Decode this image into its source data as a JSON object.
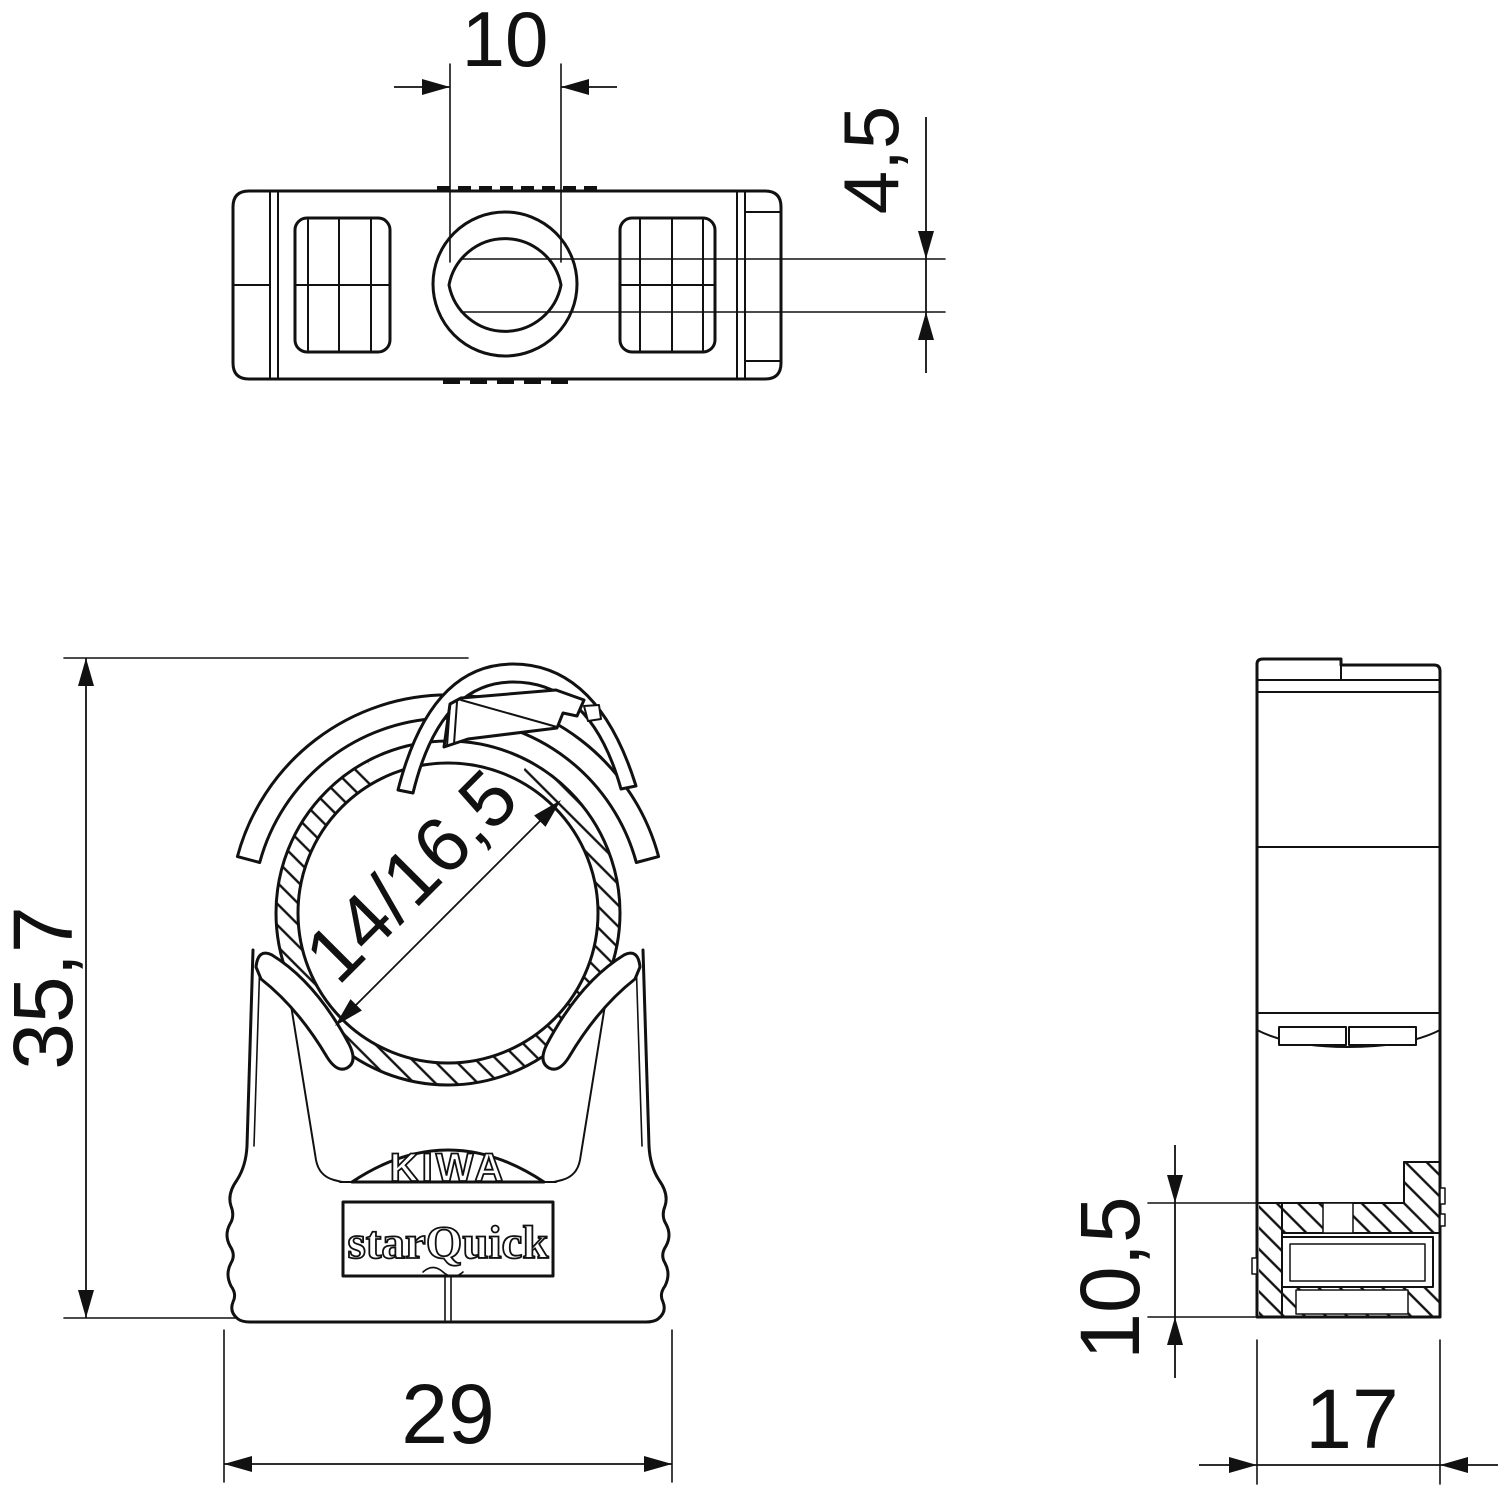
{
  "labels": {
    "certification": "KIWA",
    "brand": "starQuick"
  },
  "dimensions": {
    "top_view": {
      "slot_width": "10",
      "screw_seat_depth": "4,5"
    },
    "front_view": {
      "overall_height": "35,7",
      "pipe_diameter_range": "14/16,5",
      "overall_width": "29"
    },
    "side_view": {
      "base_height": "10,5",
      "overall_depth": "17"
    }
  },
  "colors": {
    "line": "#111111",
    "background": "#ffffff"
  }
}
